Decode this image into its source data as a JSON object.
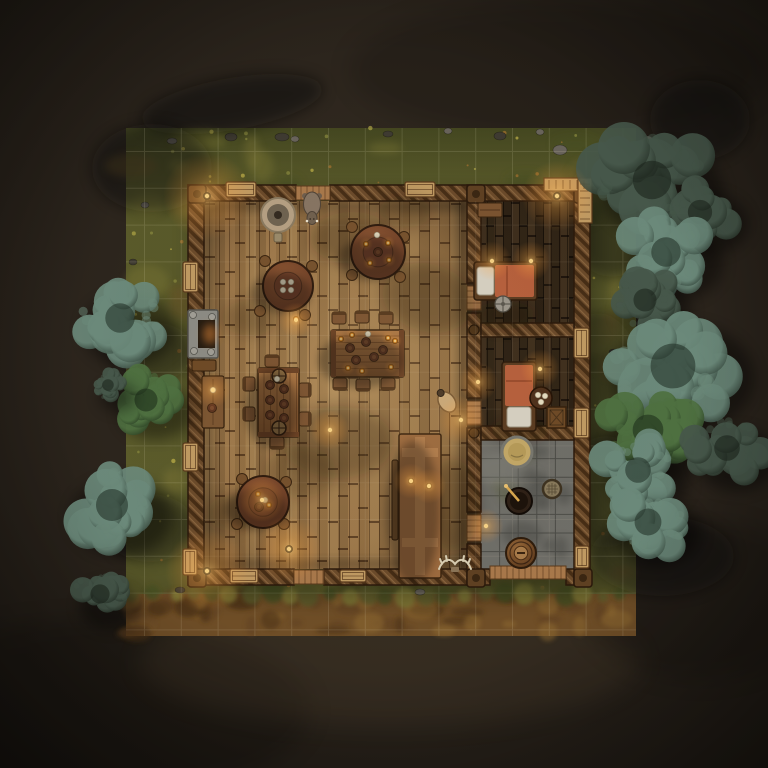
{
  "scene": {
    "title": "top-down tavern battlemap",
    "canvas": {
      "width": 768,
      "height": 768
    },
    "seed": 1337,
    "palette": {
      "bg": "#2b241c",
      "bg_dark": "#191510",
      "grass": "#5c5c2b",
      "grass_dark": "#475020",
      "grass_light": "#7d7836",
      "grass_brown": "#6b5326",
      "dirt": "#6f4e27",
      "dirt_dark": "#4b3215",
      "dirt_light": "#8f6a33",
      "wall": "#6b4a2a",
      "wall_dark": "#462d15",
      "floor": "#9a7547",
      "plank_dark": "#46331f",
      "stone": "#6f6e68",
      "stone_dark": "#55544e",
      "blanket": "#b65f3c",
      "linen": "#d6d0c2",
      "amber": "#ffb347",
      "cream": "#e6dcc0",
      "tree_dark_hi": "#46574a",
      "tree_dark_lo": "#1c251c",
      "tree_teal_hi": "#6b897a",
      "tree_teal_lo": "#25332a",
      "tree_green_hi": "#4e7040",
      "tree_green_lo": "#1e2f1a",
      "grid": "rgba(255,244,210,0.12)"
    },
    "map_rect": {
      "x": 126,
      "y": 128,
      "w": 510,
      "h": 508
    },
    "dirt_band": {
      "x": 126,
      "y": 594,
      "w": 510,
      "h": 42
    },
    "grid": {
      "ox": 144.5,
      "oy": 151.5,
      "step": 36.8
    },
    "building": {
      "outer": {
        "x": 188,
        "y": 185,
        "w": 402,
        "h": 400
      },
      "main_floor": {
        "x": 204,
        "y": 201,
        "w": 263,
        "h": 368
      },
      "wing_floor": {
        "x": 481,
        "y": 201,
        "w": 93,
        "h": 368
      },
      "stone_floor": {
        "x": 481,
        "y": 440,
        "w": 93,
        "h": 129
      },
      "partition_underlay": {
        "x": 467,
        "y": 201,
        "w": 14,
        "h": 368
      },
      "walls": [
        {
          "x": 188,
          "y": 185,
          "w": 108,
          "h": 16
        },
        {
          "x": 330,
          "y": 185,
          "w": 260,
          "h": 16
        },
        {
          "x": 188,
          "y": 569,
          "w": 106,
          "h": 16
        },
        {
          "x": 324,
          "y": 569,
          "w": 166,
          "h": 16
        },
        {
          "x": 566,
          "y": 569,
          "w": 24,
          "h": 16
        },
        {
          "x": 188,
          "y": 185,
          "w": 16,
          "h": 400
        },
        {
          "x": 574,
          "y": 185,
          "w": 16,
          "h": 400
        },
        {
          "x": 467,
          "y": 185,
          "w": 14,
          "h": 98
        },
        {
          "x": 467,
          "y": 313,
          "w": 14,
          "h": 85
        },
        {
          "x": 467,
          "y": 428,
          "w": 14,
          "h": 84
        },
        {
          "x": 467,
          "y": 544,
          "w": 14,
          "h": 41
        },
        {
          "x": 481,
          "y": 323,
          "w": 93,
          "h": 14
        },
        {
          "x": 481,
          "y": 426,
          "w": 93,
          "h": 14
        }
      ],
      "posts": [
        [
          188,
          185
        ],
        [
          574,
          185
        ],
        [
          188,
          569
        ],
        [
          574,
          569
        ],
        [
          467,
          185
        ],
        [
          467,
          569
        ]
      ],
      "junctions": [
        [
          474,
          330
        ],
        [
          474,
          433
        ],
        [
          474,
          520
        ]
      ],
      "thresholds": [
        {
          "o": "h",
          "x": 296,
          "y": 186,
          "w": 34,
          "h": 14
        },
        {
          "o": "h",
          "x": 294,
          "y": 570,
          "w": 30,
          "h": 14
        },
        {
          "o": "h",
          "x": 490,
          "y": 566,
          "w": 76,
          "h": 13
        },
        {
          "o": "v",
          "x": 467,
          "y": 286,
          "w": 14,
          "h": 24
        },
        {
          "o": "v",
          "x": 467,
          "y": 401,
          "w": 14,
          "h": 24
        },
        {
          "o": "v",
          "x": 467,
          "y": 515,
          "w": 14,
          "h": 26
        }
      ],
      "features": [
        {
          "type": "bench",
          "x": 226,
          "y": 182,
          "w": 30,
          "h": 15
        },
        {
          "type": "bench",
          "x": 405,
          "y": 182,
          "w": 30,
          "h": 15
        },
        {
          "type": "bench",
          "x": 230,
          "y": 569,
          "w": 28,
          "h": 14
        },
        {
          "type": "bench",
          "x": 340,
          "y": 570,
          "w": 26,
          "h": 12
        },
        {
          "type": "window",
          "x": 183,
          "y": 262,
          "w": 15,
          "h": 30
        },
        {
          "type": "window",
          "x": 183,
          "y": 443,
          "w": 15,
          "h": 28
        },
        {
          "type": "window",
          "x": 183,
          "y": 549,
          "w": 14,
          "h": 26
        },
        {
          "type": "window",
          "x": 574,
          "y": 328,
          "w": 15,
          "h": 30
        },
        {
          "type": "window",
          "x": 574,
          "y": 408,
          "w": 15,
          "h": 30
        },
        {
          "type": "window",
          "x": 575,
          "y": 546,
          "w": 14,
          "h": 22
        },
        {
          "type": "porch",
          "x": 544,
          "y": 178,
          "w": 48,
          "h": 45
        }
      ]
    },
    "furniture": [
      {
        "type": "basin",
        "x": 278,
        "y": 215,
        "r": 17
      },
      {
        "type": "boar",
        "x": 312,
        "y": 206
      },
      {
        "type": "round_table",
        "x": 288,
        "y": 286,
        "r": 25,
        "items": {
          "amber": [
            [
              296,
              319
            ]
          ],
          "cream": [
            [
              283,
              282
            ],
            [
              291,
              282
            ],
            [
              283,
              290
            ],
            [
              291,
              290
            ]
          ],
          "trencher": []
        },
        "stools": [
          [
            265,
            261
          ],
          [
            312,
            266
          ],
          [
            260,
            311
          ],
          [
            305,
            315
          ]
        ]
      },
      {
        "type": "round_table",
        "x": 378,
        "y": 252,
        "r": 27,
        "items": {
          "amber": [
            [
              366,
              244
            ],
            [
              388,
              243
            ],
            [
              370,
              263
            ],
            [
              389,
              260
            ]
          ],
          "cream": [
            [
              377,
              235
            ]
          ],
          "trencher": [
            [
              378,
              252
            ]
          ]
        },
        "stools": [
          [
            352,
            227
          ],
          [
            404,
            237
          ],
          [
            400,
            277
          ],
          [
            352,
            275
          ]
        ]
      },
      {
        "type": "round_table",
        "x": 263,
        "y": 502,
        "r": 26,
        "items": {
          "amber": [
            [
              258,
              494
            ],
            [
              269,
              505
            ]
          ],
          "cream": [
            [
              265,
              500
            ]
          ],
          "trencher": [
            [
              259,
              507
            ]
          ]
        },
        "stools": [
          [
            242,
            479
          ],
          [
            286,
            482
          ],
          [
            237,
            524
          ],
          [
            284,
            524
          ]
        ]
      },
      {
        "type": "rect_table",
        "x": 331,
        "y": 330,
        "w": 73,
        "h": 47,
        "orient": "h",
        "items": {
          "amber": [
            [
              341,
              339
            ],
            [
              352,
              335
            ],
            [
              388,
              338
            ],
            [
              395,
              341
            ],
            [
              348,
              368
            ],
            [
              362,
              371
            ],
            [
              391,
              367
            ]
          ],
          "cream": [
            [
              368,
              334
            ]
          ],
          "trencher": [
            [
              350,
              348
            ],
            [
              366,
              342
            ],
            [
              383,
              350
            ],
            [
              356,
              360
            ],
            [
              374,
              357
            ]
          ]
        },
        "chairs": [
          [
            339,
            318,
            "n"
          ],
          [
            362,
            317,
            "n"
          ],
          [
            386,
            318,
            "n"
          ],
          [
            340,
            384,
            "s"
          ],
          [
            363,
            385,
            "s"
          ],
          [
            388,
            384,
            "s"
          ]
        ]
      },
      {
        "type": "rect_table",
        "x": 258,
        "y": 368,
        "w": 41,
        "h": 69,
        "orient": "v",
        "items": {
          "amber": [],
          "cream": [
            [
              277,
              379
            ]
          ],
          "trencher": [
            [
              270,
              385
            ],
            [
              284,
              389
            ],
            [
              270,
              400
            ],
            [
              284,
              404
            ],
            [
              270,
              415
            ],
            [
              284,
              418
            ]
          ]
        },
        "wheels": [
          [
            279,
            376
          ],
          [
            279,
            428
          ]
        ],
        "chairs": [
          [
            249,
            384,
            "w"
          ],
          [
            249,
            414,
            "w"
          ],
          [
            305,
            390,
            "e"
          ],
          [
            305,
            419,
            "e"
          ],
          [
            272,
            361,
            "n"
          ],
          [
            277,
            443,
            "s"
          ]
        ]
      },
      {
        "type": "cross_table",
        "x": 399,
        "y": 434,
        "w": 42,
        "h": 144,
        "candles": [
          [
            411,
            481
          ],
          [
            429,
            486
          ]
        ],
        "bench": [
          392,
          460,
          6,
          80
        ]
      },
      {
        "type": "side_table",
        "x": 202,
        "y": 376,
        "w": 22,
        "h": 52,
        "dots": [
          [
            213,
            390
          ],
          [
            212,
            408
          ]
        ]
      },
      {
        "type": "fireplace",
        "x": 188,
        "y": 310,
        "w": 30,
        "h": 48
      },
      {
        "type": "jug",
        "x": 447,
        "y": 402
      },
      {
        "type": "bed",
        "x": 477,
        "y": 265,
        "w": 57,
        "h": 32,
        "orient": "h"
      },
      {
        "type": "shelf",
        "x": 478,
        "y": 203,
        "w": 24,
        "h": 14
      },
      {
        "type": "wheel_disc",
        "x": 503,
        "y": 304,
        "r": 8
      },
      {
        "type": "bed",
        "x": 505,
        "y": 365,
        "w": 28,
        "h": 63,
        "orient": "v"
      },
      {
        "type": "side_round",
        "x": 541,
        "y": 398,
        "r": 11,
        "dots": [
          [
            538,
            395
          ],
          [
            545,
            396
          ],
          [
            541,
            402
          ]
        ]
      },
      {
        "type": "crate",
        "x": 547,
        "y": 407,
        "w": 19,
        "h": 21
      },
      {
        "type": "tub",
        "x": 517,
        "y": 452,
        "r": 15
      },
      {
        "type": "cauldron",
        "x": 519,
        "y": 501,
        "r": 13
      },
      {
        "type": "sieve",
        "x": 552,
        "y": 489,
        "r": 9
      },
      {
        "type": "barrel",
        "x": 521,
        "y": 553,
        "r": 15
      },
      {
        "type": "antlers",
        "x": 455,
        "y": 567
      },
      {
        "type": "lamp_post",
        "x": 207,
        "y": 196
      },
      {
        "type": "lamp_post",
        "x": 557,
        "y": 196
      },
      {
        "type": "lamp_post",
        "x": 207,
        "y": 571
      },
      {
        "type": "lamp_post",
        "x": 289,
        "y": 549
      }
    ],
    "trees": [
      [
        652,
        180,
        60,
        "dark"
      ],
      [
        700,
        212,
        38,
        "dark"
      ],
      [
        666,
        252,
        46,
        "teal"
      ],
      [
        645,
        300,
        36,
        "dark"
      ],
      [
        673,
        366,
        70,
        "teal"
      ],
      [
        648,
        430,
        48,
        "green"
      ],
      [
        638,
        470,
        40,
        "teal"
      ],
      [
        648,
        522,
        42,
        "teal"
      ],
      [
        727,
        448,
        40,
        "dark"
      ],
      [
        120,
        318,
        46,
        "teal"
      ],
      [
        146,
        400,
        36,
        "green"
      ],
      [
        108,
        385,
        18,
        "dark"
      ],
      [
        112,
        505,
        50,
        "teal"
      ],
      [
        100,
        594,
        30,
        "dark"
      ]
    ],
    "tree_shadows": [
      [
        232,
        104,
        92,
        26,
        -10,
        0.5
      ],
      [
        152,
        168,
        60,
        44,
        0,
        0.45
      ],
      [
        612,
        215,
        48,
        62,
        0,
        0.4
      ],
      [
        598,
        385,
        44,
        72,
        0,
        0.38
      ],
      [
        606,
        492,
        42,
        56,
        0,
        0.38
      ],
      [
        152,
        352,
        42,
        30,
        0,
        0.4
      ],
      [
        150,
        528,
        46,
        34,
        0,
        0.4
      ],
      [
        662,
        556,
        72,
        40,
        0,
        0.42
      ],
      [
        700,
        120,
        50,
        40,
        0,
        0.45
      ]
    ],
    "interior_shadows": [
      [
        352,
        238,
        42,
        26,
        0,
        0.28
      ],
      [
        428,
        298,
        46,
        34,
        15,
        0.28
      ],
      [
        250,
        318,
        28,
        18,
        0,
        0.22
      ],
      [
        338,
        442,
        55,
        36,
        0,
        0.26
      ],
      [
        452,
        505,
        28,
        46,
        0,
        0.26
      ],
      [
        300,
        472,
        36,
        26,
        0,
        0.2
      ],
      [
        405,
        212,
        26,
        16,
        0,
        0.22
      ],
      [
        233,
        513,
        26,
        18,
        0,
        0.22
      ],
      [
        505,
        315,
        30,
        14,
        0,
        0.3
      ],
      [
        520,
        430,
        30,
        12,
        0,
        0.3
      ]
    ],
    "lights": [
      [
        207,
        196,
        20
      ],
      [
        557,
        196,
        16
      ],
      [
        207,
        571,
        19
      ],
      [
        289,
        549,
        15
      ],
      [
        492,
        261,
        9
      ],
      [
        531,
        261,
        9
      ],
      [
        478,
        382,
        9
      ],
      [
        540,
        369,
        9
      ],
      [
        461,
        420,
        11
      ],
      [
        486,
        526,
        8
      ],
      [
        296,
        320,
        8
      ],
      [
        262,
        500,
        10
      ],
      [
        411,
        481,
        8
      ],
      [
        429,
        486,
        8
      ],
      [
        213,
        390,
        8
      ],
      [
        330,
        430,
        9
      ]
    ],
    "pebbles": [
      [
        172,
        141,
        5,
        3
      ],
      [
        231,
        137,
        6,
        4
      ],
      [
        295,
        139,
        4,
        3
      ],
      [
        388,
        134,
        5,
        3
      ],
      [
        448,
        131,
        4,
        3
      ],
      [
        500,
        136,
        6,
        4
      ],
      [
        540,
        132,
        4,
        3
      ],
      [
        610,
        160,
        5,
        4
      ],
      [
        145,
        205,
        4,
        3
      ],
      [
        133,
        262,
        4,
        3
      ],
      [
        620,
        305,
        4,
        3
      ],
      [
        614,
        352,
        5,
        3
      ],
      [
        560,
        150,
        7,
        5
      ],
      [
        282,
        137,
        7,
        4
      ],
      [
        648,
        140,
        5,
        4
      ],
      [
        180,
        590,
        5,
        3
      ],
      [
        420,
        592,
        5,
        3
      ]
    ]
  }
}
